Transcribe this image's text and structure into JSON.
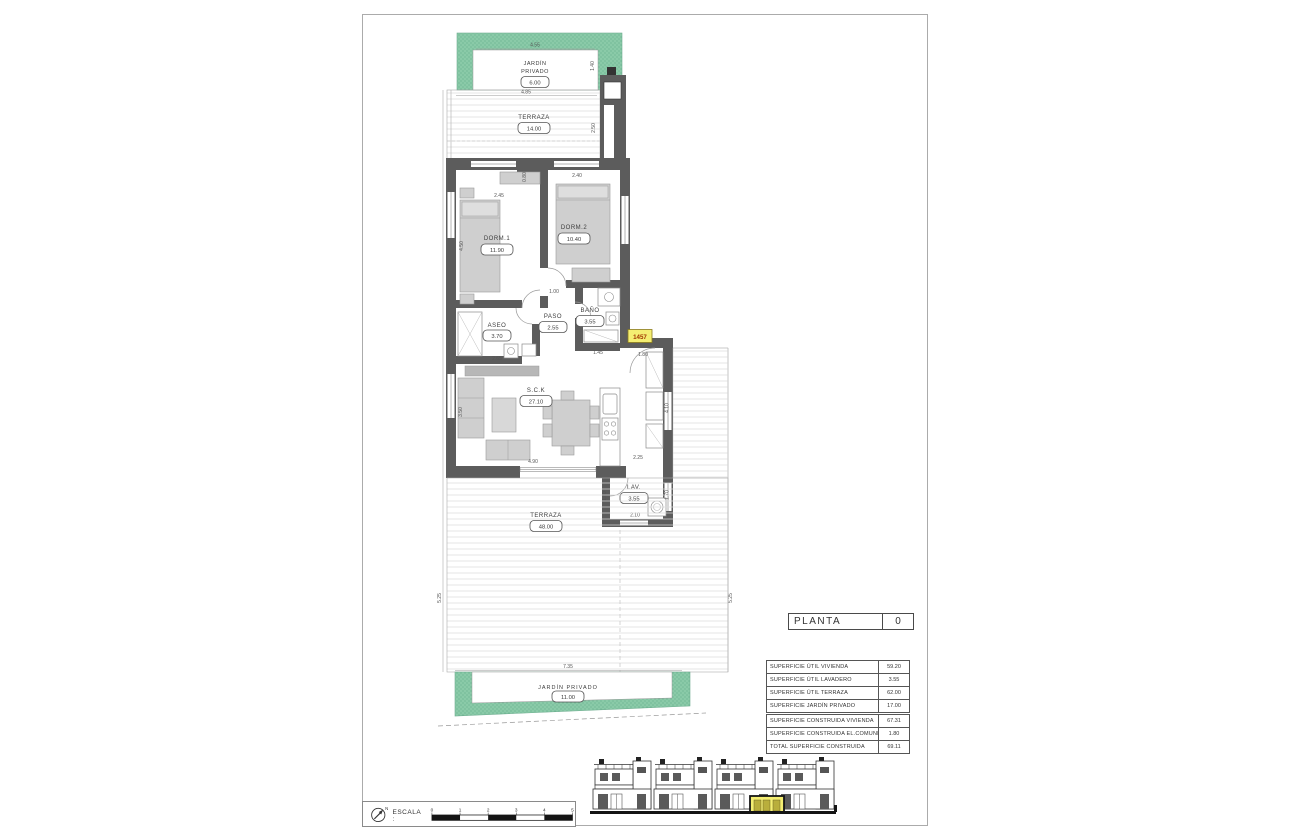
{
  "title_block": {
    "label": "PLANTA",
    "number": "0"
  },
  "unit_badge": "1457",
  "drawing": {
    "rooms": {
      "jardin_top": {
        "name_line1": "JARDÍN",
        "name_line2": "PRIVADO",
        "area": "6.00"
      },
      "terraza_top": {
        "name": "TERRAZA",
        "area": "14.00"
      },
      "dorm1": {
        "name": "DORM.1",
        "area": "11.90"
      },
      "dorm2": {
        "name": "DORM.2",
        "area": "10.40"
      },
      "aseo": {
        "name": "ASEO",
        "area": "3.70"
      },
      "paso": {
        "name": "PASO",
        "area": "2.55"
      },
      "bano": {
        "name": "BAÑO",
        "area": "3.55"
      },
      "sck": {
        "name": "S.C.K",
        "area": "27.10"
      },
      "lav": {
        "name": "LAV.",
        "area": "3.55"
      },
      "terraza_bottom": {
        "name": "TERRAZA",
        "area": "48.00"
      },
      "jardin_bottom": {
        "name": "JARDÍN PRIVADO",
        "area": "11.00"
      }
    },
    "dims": {
      "garden_top_width": "4.55",
      "terrace_top_width": "4.85",
      "garden_top_right": "1.40",
      "terrace_top_depth": "2.50",
      "recess": "0.80",
      "dorm1_window": "2.45",
      "dorm2_window": "2.40",
      "dorm1_depth": "4.50",
      "hall": "1.00",
      "aseo_width": "2.65",
      "bano_width": "1.45",
      "entrance_width": "1.80",
      "living_depth": "3.50",
      "living_width": "4.90",
      "kitchen_pass": "2.25",
      "kitchen_depth": "4.10",
      "lav_left_depth": "1.80",
      "lav_right_depth": "1.70",
      "lav_width": "2.10",
      "terrace_left": "5.25",
      "terrace_right": "5.25",
      "garden_bottom_width": "7.35"
    },
    "colors": {
      "garden_green": "#8acaa8",
      "wall_gray": "#5c5c5c",
      "highlight_yellow": "#f4ee72",
      "unit_text": "#a03500"
    }
  },
  "area_tables": {
    "useful": [
      {
        "label": "SUPERFICIE ÚTIL VIVIENDA",
        "value": "59.20"
      },
      {
        "label": "SUPERFICIE ÚTIL LAVADERO",
        "value": "3.55"
      },
      {
        "label": "SUPERFICIE ÚTIL TERRAZA",
        "value": "62.00"
      },
      {
        "label": "SUPERFICIE JARDÍN PRIVADO",
        "value": "17.00"
      }
    ],
    "built": [
      {
        "label": "SUPERFICIE CONSTRUIDA VIVIENDA",
        "value": "67.31"
      },
      {
        "label": "SUPERFICIE CONSTRUIDA EL.COMUNES",
        "value": "1.80"
      },
      {
        "label": "TOTAL SUPERFICIE CONSTRUIDA",
        "value": "69.11"
      }
    ]
  },
  "scale_bar": {
    "label": "ESCALA :",
    "ticks": [
      "0",
      "1",
      "2",
      "3",
      "4",
      "5"
    ],
    "north": "N"
  }
}
